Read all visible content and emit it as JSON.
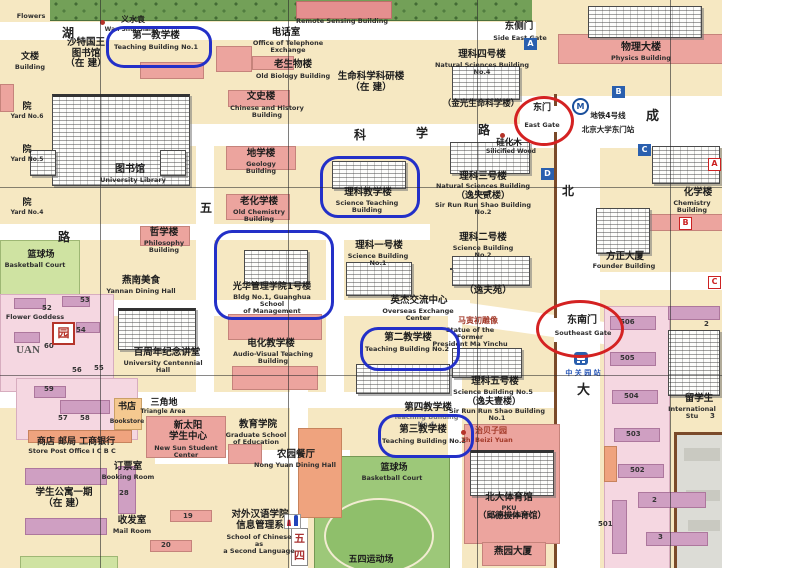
{
  "colors": {
    "annotation_blue": "#2330c8",
    "annotation_red": "#d42222",
    "block_beige": "#f6e8c2",
    "building_pink": "#eca49e",
    "green": "#9dc879",
    "wall_brown": "#7a4a2a"
  },
  "labels": {
    "flowers": {
      "en": "Flowers"
    },
    "wanshui": {
      "zh": "义水袁",
      "en": "Wan Shui Siano"
    },
    "kingsaud": {
      "zh": "沙特国王\n图书馆\n（在 建）"
    },
    "waiwen": {
      "zh": "文楼",
      "en": "Building"
    },
    "teaching1": {
      "zh": "第一教学楼",
      "en": "Teaching Building No.1"
    },
    "telephone": {
      "zh": "电话室",
      "en": "Office of Telephone\nExchange"
    },
    "oldbio": {
      "zh": "老生物楼",
      "en": "Old Biology Building"
    },
    "remote": {
      "en": "Remote Sensing Building"
    },
    "sidegate": {
      "zh": "东侧门",
      "en": "Side East Gate"
    },
    "lifesci": {
      "zh": "生命科学科研楼\n（在 建）"
    },
    "sci4": {
      "zh": "理科四号楼",
      "en": "Natural Sciences Building No.4",
      "zh2": "（金光生命科学楼）"
    },
    "physics": {
      "zh": "物理大楼",
      "en": "Physics Building"
    },
    "eastgate": {
      "zh": "东门",
      "en": "East Gate"
    },
    "metro": {
      "line": "地铁4号线",
      "station": "北京大学东门站"
    },
    "silicified": {
      "zh": "硅化木",
      "en": "Silicified Wood"
    },
    "sci3": {
      "zh": "理科三号楼",
      "en": "Natural Sciences Building No.3",
      "zh2": "（逸夫贰楼）",
      "en2": "Sir Run Run Shao Building No.2"
    },
    "chemistry": {
      "zh": "化学楼",
      "en": "Chemistry Building"
    },
    "founder": {
      "zh": "方正大厦",
      "en": "Founder Building"
    },
    "library": {
      "zh": "图书馆",
      "en": "University Library"
    },
    "yard6": {
      "zh": "院",
      "en": "Yard No.6"
    },
    "yard5": {
      "zh": "院",
      "en": "Yard No.5"
    },
    "yard4": {
      "zh": "院",
      "en": "Yard No.4"
    },
    "wenshi": {
      "zh": "文史楼",
      "en": "Chinese and History Building"
    },
    "geology": {
      "zh": "地学楼",
      "en": "Geology Building"
    },
    "sciteaching": {
      "zh": "理科教学楼",
      "en": "Science Teaching Building"
    },
    "oldchem": {
      "zh": "老化学楼",
      "en": "Old Chemistry Building"
    },
    "philosophy": {
      "zh": "哲学楼",
      "en": "Philosophy Building"
    },
    "sci1": {
      "zh": "理科一号楼",
      "en": "Science Building No.1"
    },
    "sci2": {
      "zh": "理科二号楼",
      "en": "Science Building No.2"
    },
    "bball1": {
      "zh": "篮球场",
      "en": "Basketball Court"
    },
    "flowergoddess": {
      "en": "Flower Goddess"
    },
    "yannan": {
      "zh": "燕南美食",
      "en": "Yannan Dining Hall"
    },
    "yuan": {
      "zh": "园"
    },
    "uan": {
      "en": "UAN"
    },
    "centennial": {
      "zh": "百周年纪念讲堂",
      "en": "University Centennial Hall"
    },
    "audiovisual": {
      "zh": "电化教学楼",
      "en": "Audio-Visual Teaching Building"
    },
    "guanghua": {
      "zh": "光华管理学院1号楼",
      "en": "Bldg No.1, Guanghua School\nof Management"
    },
    "overseas": {
      "zh": "英杰交流中心",
      "en": "Overseas Exchange Center"
    },
    "yifuyuan": {
      "zh": "（逸夫苑）"
    },
    "teaching2": {
      "zh": "第二教学楼",
      "en": "Teaching Building No.2"
    },
    "mayinchu": {
      "zh": "马寅初雕像",
      "en": "Statue of the Former\nPresident Ma Yinchu"
    },
    "segate": {
      "zh": "东南门",
      "en": "Southeast Gate"
    },
    "zgy": {
      "zh": "中 关 园 站"
    },
    "sci5": {
      "zh": "理科五号楼",
      "en": "Science Building No.5",
      "zh2": "（逸夫壹楼）",
      "en2": "Sir Run Run Shao Building No.1"
    },
    "teaching4": {
      "zh": "第四教学楼",
      "en": "Teaching Building No.4"
    },
    "teaching3": {
      "zh": "第三教学楼",
      "en": "Teaching Building No.3"
    },
    "zhibeizi": {
      "zh": "治贝子园",
      "en": "Zhi Beizi Yuan"
    },
    "bball2": {
      "zh": "篮球场",
      "en": "Basketball Court"
    },
    "gym": {
      "zh": "北大体育馆",
      "en": "PKU Gymnasium",
      "zh2": "（邱德拔体育馆）"
    },
    "yanyuan": {
      "zh": "燕园大厦"
    },
    "storepost": {
      "zh": "商店  邮局  工商银行",
      "en": "Store  Post Office  I C B C"
    },
    "triangle": {
      "zh": "三角地",
      "en": "Triangle Area"
    },
    "bookstore": {
      "zh": "书店",
      "en": "Bookstore"
    },
    "newsun": {
      "zh": "新太阳\n学生中心",
      "en": "New Sun Student Center"
    },
    "booking": {
      "zh": "订票室",
      "en": "Booking Room"
    },
    "mail": {
      "zh": "收发室",
      "en": "Mail Room"
    },
    "apt": {
      "zh": "学生公寓一期\n（在 建）"
    },
    "edu": {
      "zh": "教育学院",
      "en": "Graduate School\nof Education"
    },
    "nongyuan": {
      "zh": "农园餐厅",
      "en": "Nong Yuan Dining Hall"
    },
    "chineselang": {
      "zh": "对外汉语学院\n信息管理系",
      "en": "School of Chinese as\na Second Language"
    },
    "field": {
      "zh": "五四运动场"
    },
    "intlstu": {
      "zh": "留学生",
      "en": "International Stu"
    }
  },
  "road_labels": {
    "hu": "湖",
    "ke": "科",
    "xue": "学",
    "lu": "路",
    "lu2": "路",
    "wu": "五",
    "wusi_wu": "五",
    "wusi_si": "四",
    "bei": "北",
    "da": "大",
    "cheng": "成"
  },
  "markers": {
    "blue": [
      "A",
      "B",
      "C",
      "D"
    ],
    "red": [
      "A",
      "B",
      "C"
    ],
    "metro_logo": "M"
  },
  "numbers": {
    "n52": "52",
    "n53": "53",
    "n54": "54",
    "n55": "55",
    "n56": "56",
    "n57": "57",
    "n58": "58",
    "n59": "59",
    "n60": "60",
    "n28": "28",
    "n19": "19",
    "n20": "20",
    "n501": "501",
    "n502": "502",
    "n503": "503",
    "n504": "504",
    "n505": "505",
    "n506": "506",
    "n2a": "2",
    "n3a": "3",
    "n2b": "2",
    "n3b": "3"
  }
}
